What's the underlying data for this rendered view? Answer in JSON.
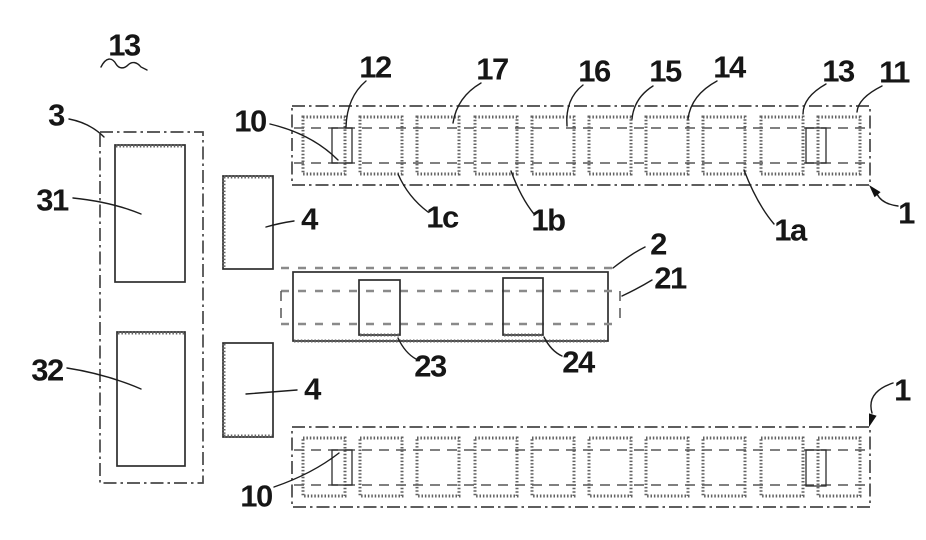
{
  "meta": {
    "background": "#ffffff",
    "line_color": "#1a1a1a",
    "stipple_color": "#616161",
    "figure_kind": "patent technical drawing"
  },
  "labels": {
    "fig_13": {
      "text": "13"
    },
    "part_3": {
      "text": "3"
    },
    "part_31": {
      "text": "31"
    },
    "part_32": {
      "text": "32"
    },
    "part_4_upper": {
      "text": "4"
    },
    "part_4_lower": {
      "text": "4"
    },
    "part_10_upper": {
      "text": "10"
    },
    "part_12": {
      "text": "12"
    },
    "part_17": {
      "text": "17"
    },
    "part_16": {
      "text": "16"
    },
    "part_15": {
      "text": "15"
    },
    "part_14": {
      "text": "14"
    },
    "part_13": {
      "text": "13"
    },
    "part_11": {
      "text": "11"
    },
    "part_1_upper": {
      "text": "1"
    },
    "part_1c": {
      "text": "1c"
    },
    "part_1b": {
      "text": "1b"
    },
    "part_1a": {
      "text": "1a"
    },
    "part_2": {
      "text": "2"
    },
    "part_21": {
      "text": "21"
    },
    "part_23": {
      "text": "23"
    },
    "part_24": {
      "text": "24"
    },
    "part_10_lower": {
      "text": "10"
    },
    "part_1_lower": {
      "text": "1"
    }
  }
}
